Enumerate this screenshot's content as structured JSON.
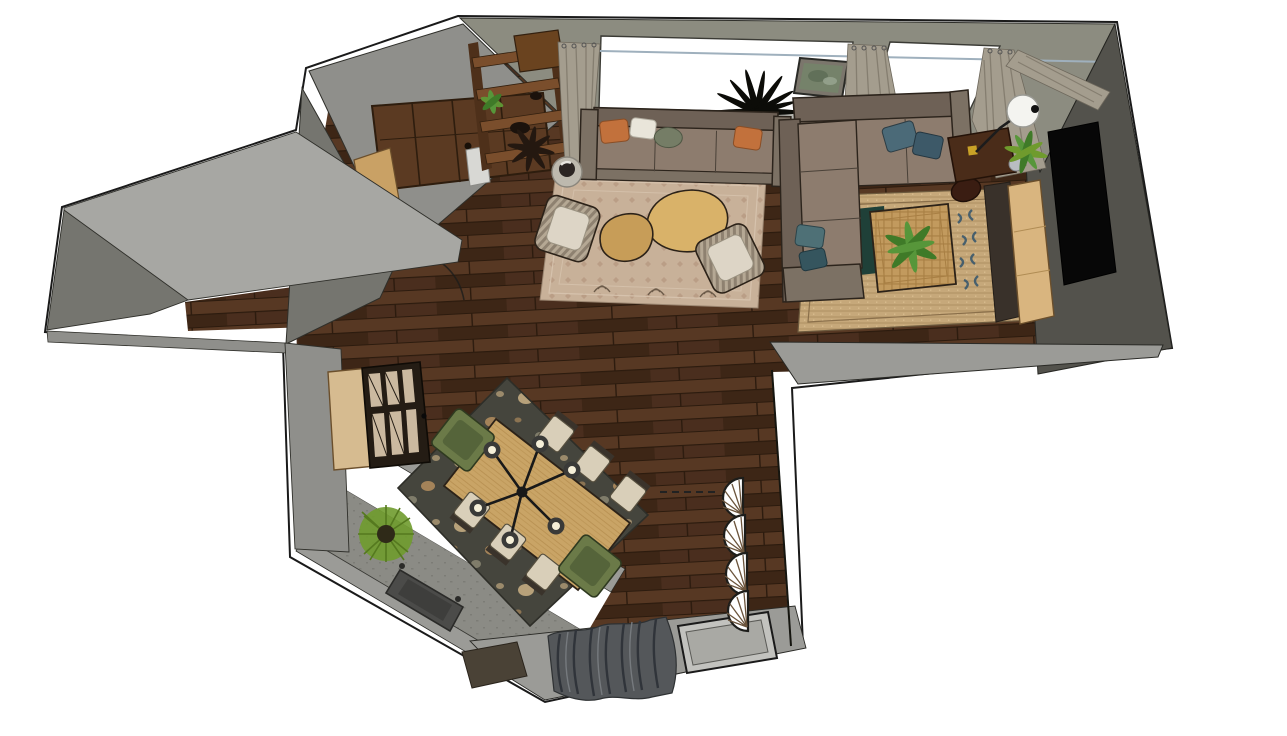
{
  "scene": {
    "title": "Top-down 3D render of apartment floor plan",
    "objects": [
      {
        "id": "entry-door",
        "label": "entry double door"
      },
      {
        "id": "shoe-cabinet",
        "label": "small wood cabinet at entry"
      },
      {
        "id": "ladder-shelf",
        "label": "wood ladder shelf with plant"
      },
      {
        "id": "window-north-1",
        "label": "large north window"
      },
      {
        "id": "window-north-2",
        "label": "north window right"
      },
      {
        "id": "curtains",
        "label": "greige curtain panels"
      },
      {
        "id": "wall-art",
        "label": "framed green artwork"
      },
      {
        "id": "palm-plant",
        "label": "dark palm plant"
      },
      {
        "id": "sofa",
        "label": "three-seat sofa with pillows"
      },
      {
        "id": "living-rug",
        "label": "beige patterned rug"
      },
      {
        "id": "coffee-tables",
        "label": "two organic oak coffee tables"
      },
      {
        "id": "armchair-left",
        "label": "striped armchair"
      },
      {
        "id": "armchair-right",
        "label": "striped armchair"
      },
      {
        "id": "side-table",
        "label": "round side table with sculpture"
      },
      {
        "id": "coat-rack",
        "label": "dark coat stand"
      },
      {
        "id": "sectional-sofa",
        "label": "L-shaped sectional sofa"
      },
      {
        "id": "jute-rug",
        "label": "jute rug with blue motif"
      },
      {
        "id": "square-coffee-table",
        "label": "wicker coffee table with plant"
      },
      {
        "id": "pouf",
        "label": "leather pouf"
      },
      {
        "id": "media-cabinet",
        "label": "dark cabinet with arc lamp base"
      },
      {
        "id": "arc-floor-lamp",
        "label": "arc floor lamp with sphere shade"
      },
      {
        "id": "console",
        "label": "light wood console with plant"
      },
      {
        "id": "tv",
        "label": "wall mounted TV"
      },
      {
        "id": "dining-table",
        "label": "oak dining table"
      },
      {
        "id": "dining-chairs",
        "label": "six beige dining chairs"
      },
      {
        "id": "dining-armchairs",
        "label": "two olive end armchairs"
      },
      {
        "id": "chandelier",
        "label": "six-bulb spider chandelier"
      },
      {
        "id": "dining-rug",
        "label": "dark floral rug"
      },
      {
        "id": "sideboard",
        "label": "sideboard with fluted glass doors"
      },
      {
        "id": "fan-sconces",
        "label": "four shell wall fans"
      },
      {
        "id": "balcony-bench",
        "label": "gray balcony bench"
      },
      {
        "id": "balcony-plant",
        "label": "round spiky plant"
      },
      {
        "id": "south-windows",
        "label": "two south windows"
      },
      {
        "id": "south-curtain",
        "label": "bunched dark curtain"
      },
      {
        "id": "doormat",
        "label": "dark doormat"
      },
      {
        "id": "hallway",
        "label": "left hallway"
      }
    ]
  },
  "palette": {
    "white": "#ffffff",
    "outline": "#1a1a1a",
    "floor_wood_1": "#4a2e1e",
    "floor_wood_2": "#573823",
    "floor_wood_3": "#3d2616",
    "floor_seam": "#2c1b0e",
    "wall_light": "#a7a7a3",
    "wall_mid": "#8f8f8b",
    "wall_dark": "#75756f",
    "wall_olive": "#8c8c80",
    "wall_charcoal": "#53524c",
    "sill_gray": "#9b9b97",
    "window_glass": "#a9a9a4",
    "glass_light": "#c2c2be",
    "curtain": "#a49d8e",
    "curtain_dark": "#857e70",
    "curtain_black": "#54575a",
    "metal_blue": "#9fb0bd",
    "sofa_body": "#8d7c6e",
    "sofa_back": "#6e6156",
    "sofa_arm": "#7c7164",
    "sofa_frame": "#2c241c",
    "pillow_orange": "#c2713c",
    "pillow_white": "#e9e5da",
    "pillow_sage": "#757d66",
    "pillow_blue1": "#4b6a78",
    "pillow_blue2": "#3d5968",
    "pillow_teal": "#4e7076",
    "pillow_teal2": "#35555e",
    "rug_living": "#c8b199",
    "rug_living_dot": "#b2937c",
    "rug_border": "#d8c6b0",
    "rug_jute": "#c6a87a",
    "rug_jute_line": "#ad8f63",
    "rug_teal": "#1f4038",
    "motif_blue": "#3a586b",
    "rug_dining": "#45453d",
    "flower_cream": "#d3b88a",
    "flower_tan": "#bb9260",
    "flower_gray": "#97937e",
    "wood_oak": "#d9b269",
    "wood_oak2": "#c79d58",
    "table_oak": "#c9a466",
    "table_grain": "#b1894a",
    "wicker": "#c29a5e",
    "wicker_line": "#a87f44",
    "stripe1": "#b5a894",
    "stripe2": "#8e8170",
    "chair_cushion": "#ddd5c6",
    "chair_beige": "#d9cfb9",
    "chair_frame": "#57503f",
    "chair_back": "#3a332b",
    "green_chair": "#6b7a48",
    "green_chair_dark": "#55643a",
    "plant_green": "#5f9434",
    "plant_mid": "#57963a",
    "plant_dark": "#3f7a28",
    "plant_lime": "#6f9b2d",
    "plant_black": "#0c0c08",
    "console_wood": "#d9b57f",
    "shelf_wood": "#4e301a",
    "shelf_bar": "#7a4e2c",
    "box_wood": "#c9a165",
    "box_wood_side": "#a9834e",
    "door_wood": "#5b3a22",
    "door_line": "#2e1d0e",
    "cabinet_dark": "#241c14",
    "slat_beige": "#cbb9a0",
    "media_brown": "#4a2c19",
    "gold": "#c9a227",
    "tv_black": "#070707",
    "pouf_brown": "#3a1d12",
    "balcony_floor": "#8b8b85",
    "balcony_speck": "#7c7c76",
    "bench_gray": "#4b4b49",
    "bench_top": "#3e3e3c",
    "mat_dark": "#4a4236",
    "lamp_arm": "#1c1c1c",
    "lamp_white": "#f4f4f0",
    "frame_pic": "#7b766c",
    "pic_green": "#75826a",
    "pic_green2": "#5c6b55",
    "sculpt_dark": "#2b2523",
    "stool_gray": "#bdb9ae",
    "dark_strip": "#39312a",
    "silver": "#b9bdc2",
    "shell_ray": "#6b543c"
  }
}
